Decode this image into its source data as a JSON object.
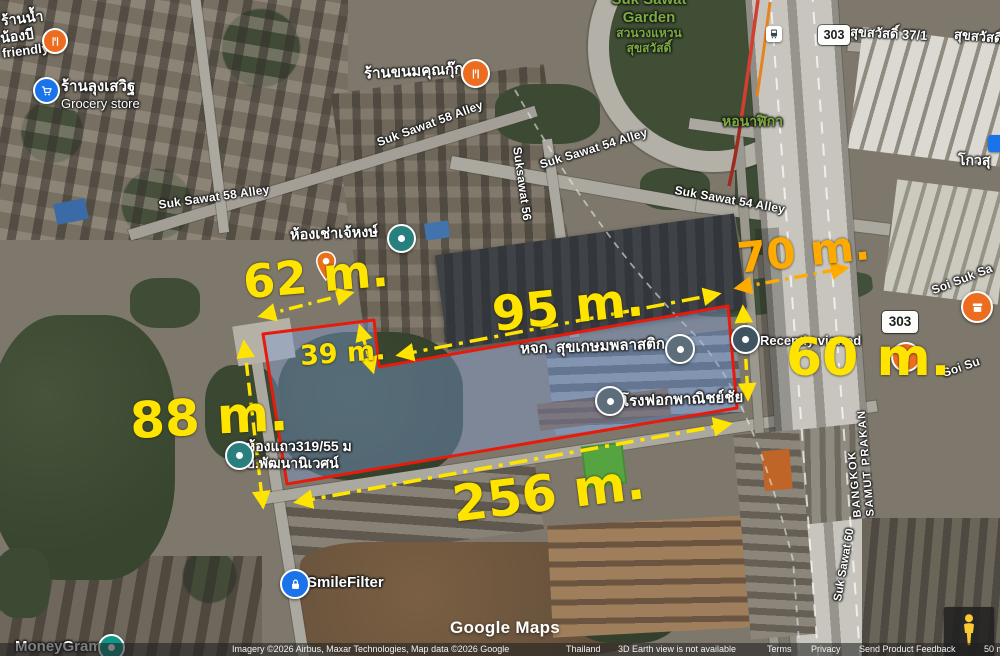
{
  "parcel": {
    "outline_color": "#e81a0c",
    "fill_color": "rgba(125,158,215,0.42)"
  },
  "colors": {
    "measure_yellow": "#ffe400",
    "measure_orange": "#ffaa00",
    "label_green": "#7cab40",
    "pin_orange": "#ec6d1f",
    "pin_blue": "#1a73e8",
    "pin_teal": "#27807d",
    "pin_gray": "#5d6d7a"
  },
  "measurements": [
    {
      "label": "62 m.",
      "color": "#ffe400"
    },
    {
      "label": "95 m.",
      "color": "#ffe400"
    },
    {
      "label": "70 m.",
      "color": "#ffaa00"
    },
    {
      "label": "39 m.",
      "color": "#ffe400"
    },
    {
      "label": "88 m.",
      "color": "#ffe400"
    },
    {
      "label": "60 m.",
      "color": "#ffe400"
    },
    {
      "label": "256 m.",
      "color": "#ffe400"
    }
  ],
  "places": {
    "water_shop": {
      "line1": "ร้านน้ำ",
      "line2": "น้องบี",
      "line3": "friendly"
    },
    "grocery": {
      "name": "ร้านลุงเสวิฐ",
      "category": "Grocery store"
    },
    "dessert_shop": {
      "name": "ร้านขนมคุณกุ๊ก"
    },
    "rental_rooms": {
      "name": "ห้องเช่าเจ้หงษ์"
    },
    "plastic_factory": {
      "name": "หจก. สุขเกษมพลาสติก"
    },
    "tannery": {
      "name": "โรงฟอกพาณิชย์ชัย"
    },
    "recently_viewed": {
      "name": "Recently viewed"
    },
    "row_houses": {
      "name": "ห้องแถว319/55 ม",
      "sub": "บ.พัฒนานิเวศน์"
    },
    "smile_filter": {
      "name": "SmileFilter"
    },
    "moneygram": {
      "name": "MoneyGram"
    },
    "kowsu": {
      "name": "โกวสุ"
    },
    "garden": {
      "line0": "Suk Sawat",
      "line1": "Garden",
      "line2": "สวนวงแหวน",
      "line3": "สุขสวัสดิ์"
    },
    "clock_tower": {
      "name": "หอนาฬิกา"
    }
  },
  "roads": {
    "badge_303": "303",
    "suk_sawat_58": "Suk Sawat 58 Alley",
    "suk_sawat_54": "Suk Sawat 54 Alley",
    "suksawat_56": "Suksawat 56",
    "suk_sawat_37_1": "สุขสวัสดิ์ 37/1",
    "soi_suk_sawat_a": "Soi Suk Sa",
    "soi_suk_sawat_b": "Soi Su",
    "bangkok": "BANGKOK",
    "samut_prakan": "SAMUT PRAKAN",
    "suk_sawat_60": "Suk Sawat 60"
  },
  "icons": {
    "restaurant": "fork-knife",
    "grocery": "shopping-cart",
    "transit": "bus",
    "security": "padlock",
    "lodging": "teardrop-pin",
    "generic_place": "dot-pin",
    "street_view": "pegman",
    "shop": "storefront"
  },
  "footer": {
    "watermark": "Google Maps",
    "attribution": "Imagery ©2026 Airbus, Maxar Technologies, Map data ©2026 Google",
    "region": "Thailand",
    "notice": "3D Earth view is not available",
    "terms": "Terms",
    "privacy": "Privacy",
    "feedback": "Send Product Feedback",
    "scale": "50 m"
  }
}
